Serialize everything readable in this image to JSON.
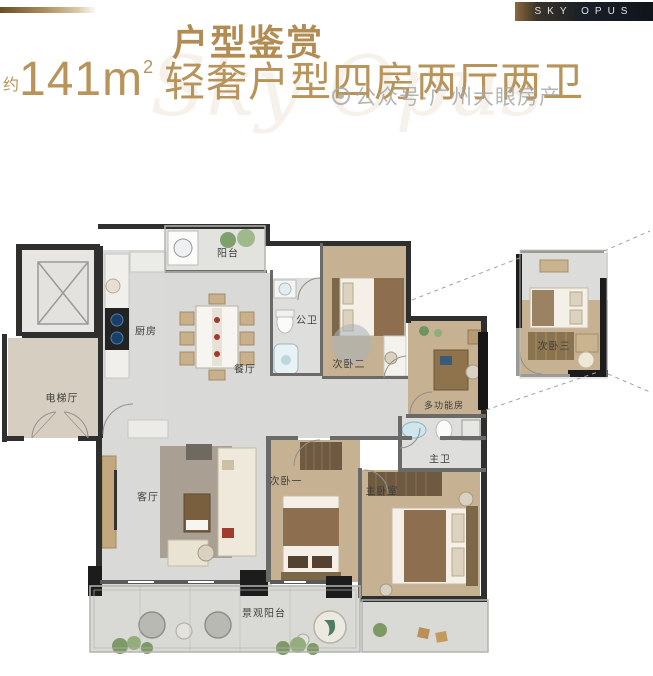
{
  "header": {
    "badge": "SKY OPUS",
    "title": "户型鉴赏",
    "approx": "约",
    "area": "141m",
    "area_sup": "2",
    "desc": "轻奢户型四房两厅两卫",
    "script_watermark": "Sky Opus"
  },
  "watermark": {
    "text": "公众号·广州大眼房产"
  },
  "rooms": [
    {
      "id": "balcony-top",
      "label": "阳台"
    },
    {
      "id": "kitchen",
      "label": "厨房"
    },
    {
      "id": "dining",
      "label": "餐厅"
    },
    {
      "id": "public-bath",
      "label": "公卫"
    },
    {
      "id": "bedroom-2",
      "label": "次卧二"
    },
    {
      "id": "multi-function",
      "label": "多功能房"
    },
    {
      "id": "bedroom-3",
      "label": "次卧三"
    },
    {
      "id": "elevator-hall",
      "label": "电梯厅"
    },
    {
      "id": "living-room",
      "label": "客厅"
    },
    {
      "id": "bedroom-1",
      "label": "次卧一"
    },
    {
      "id": "master-bath",
      "label": "主卫"
    },
    {
      "id": "master-bedroom",
      "label": "主卧室"
    },
    {
      "id": "view-balcony",
      "label": "景观阳台"
    }
  ],
  "colors": {
    "accent_gold": "#b28c52",
    "subtitle_gold": "#b8935a",
    "badge_bg": "#10151b",
    "wall_dark": "#2f2f2f",
    "wood_floor": "#c6b193",
    "marble_floor": "#d9d9d7",
    "elevator_hall_floor": "#d6cec0",
    "watermark_gray": "#a8a8a5"
  }
}
